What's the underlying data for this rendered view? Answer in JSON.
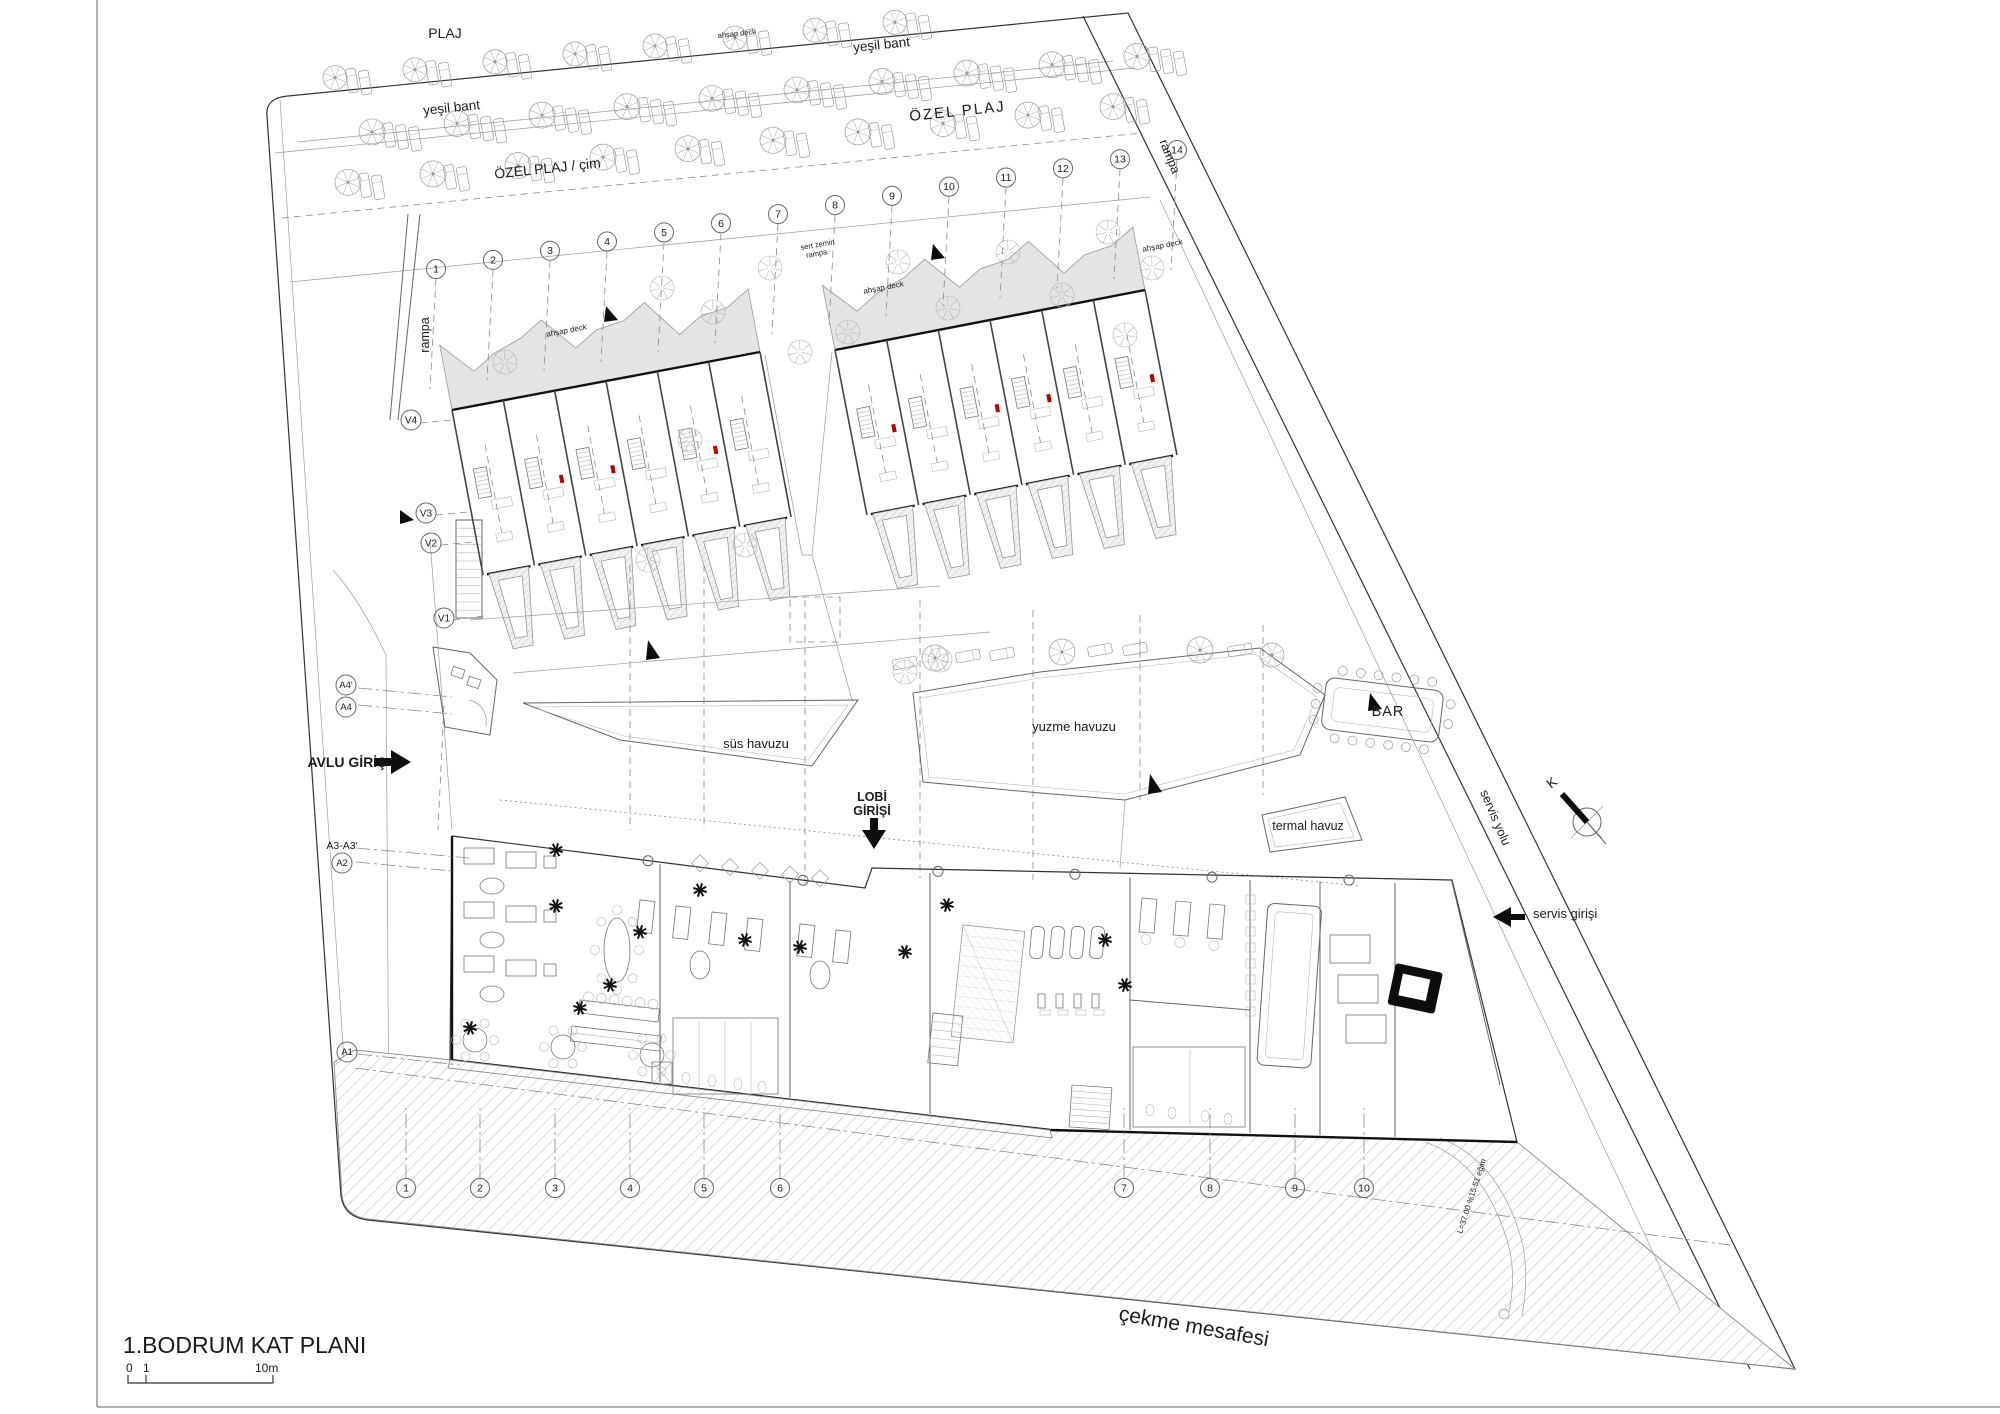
{
  "colors": {
    "accent_red": "#bb0000",
    "deck_fill": "#e4e4e4",
    "ink": "#333333",
    "paper": "#ffffff"
  },
  "labels": {
    "plaj": "PLAJ",
    "yesil_bant_left": "yeşil bant",
    "yesil_bant_right": "yeşil bant",
    "ozel_plaj": "ÖZEL PLAJ",
    "ozel_plaj_cim": "ÖZEL PLAJ / çim",
    "rampa_left": "rampa",
    "rampa_right": "rampa",
    "sert_zemin_line1": "sert zemin",
    "sert_zemin_line2": "rampa",
    "ahsap_deck": "ahşap deck",
    "sus_havuzu": "süs havuzu",
    "yuzme_havuzu": "yuzme havuzu",
    "bar": "BAR",
    "termal_havuz": "termal havuz",
    "avlu_giris": "AVLU GİRİŞ",
    "lobi_girisi_line1": "LOBİ",
    "lobi_girisi_line2": "GİRİŞİ",
    "servis_yolu": "servis yolu",
    "servis_girisi": "servis girişi",
    "cekme_mesafesi": "çekme mesafesi",
    "ramp_slope_note": "L=37.00  %15.51 eğim",
    "north": "K"
  },
  "grid": {
    "top": [
      "1",
      "2",
      "3",
      "4",
      "5",
      "6",
      "7",
      "8",
      "9",
      "10",
      "11",
      "12",
      "13",
      "14"
    ],
    "bottom": [
      "1",
      "2",
      "3",
      "4",
      "5",
      "6",
      "7",
      "8",
      "9",
      "10"
    ]
  },
  "markers": {
    "v4": "V4",
    "v3": "V3",
    "v2": "V2",
    "v1": "V1",
    "a4p": "A4'",
    "a4": "A4",
    "a3": "A3-A3'",
    "a2": "A2",
    "a1": "A1"
  },
  "title_block": {
    "title": "1.BODRUM KAT PLANI",
    "scale_0": "0",
    "scale_1": "1",
    "scale_10": "10m"
  }
}
